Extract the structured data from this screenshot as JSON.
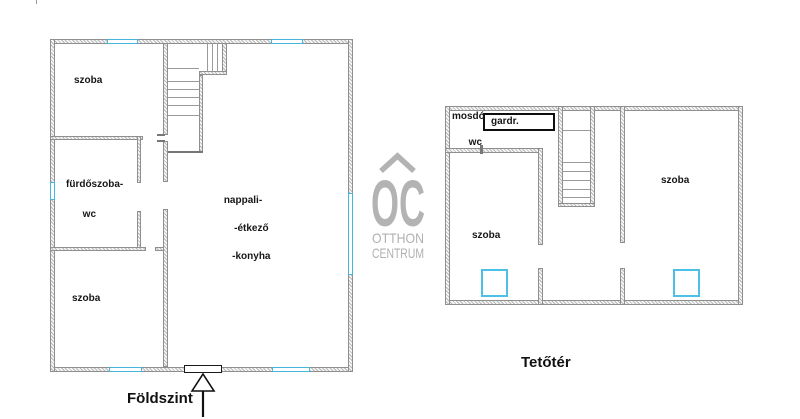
{
  "ground_floor": {
    "title": "Földszint",
    "rooms": {
      "bedroom_top": "szoba",
      "bathroom_line1": "fürdőszoba-",
      "bathroom_line2": "wc",
      "living_line1": "nappali-",
      "living_line2": "-étkező",
      "living_line3": "-konyha",
      "bedroom_bottom": "szoba"
    }
  },
  "attic": {
    "title": "Tetőtér",
    "rooms": {
      "washroom_line1": "mosdó",
      "washroom_line2": "wc",
      "wardrobe": "gardr.",
      "bedroom_left": "szoba",
      "bedroom_right": "szoba"
    }
  },
  "watermark": {
    "logo_text": "OC",
    "brand_line1": "OTTHON",
    "brand_line2": "CENTRUM"
  },
  "colors": {
    "window_accent": "#45b6e0",
    "wall_edge": "#8f8f8f",
    "watermark_gray": "#b3b3b3"
  }
}
